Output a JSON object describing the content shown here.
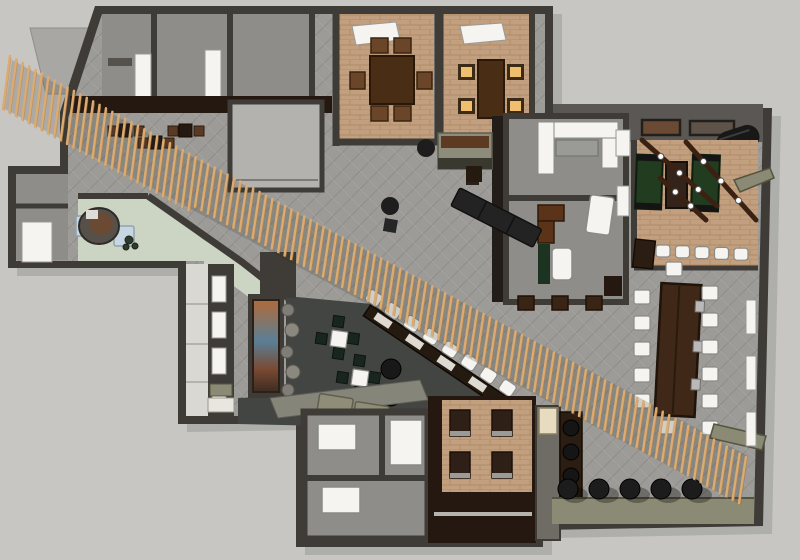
{
  "scene": {
    "kind": "3d-rendered-floor-plan",
    "subject": "restaurant-interior-top-down-render",
    "rooms": [
      "entry-lobby",
      "reception-desk",
      "private-dining-a",
      "private-dining-b",
      "service-rooms",
      "kitchen-prep",
      "office",
      "games-room",
      "main-hall",
      "diagonal-bar",
      "lounge",
      "communal-table-area",
      "restrooms",
      "booth-dining",
      "wine-storage",
      "window-gallery"
    ],
    "signature_feature": "diagonal-wood-slat-ceiling-band"
  },
  "palette": {
    "bg": "#c7c6c2",
    "wall": "#3f3c38",
    "wallMid": "#5a5754",
    "wallLight": "#6f6c68",
    "tile": "#9c9b97",
    "tileLine": "#8b8a86",
    "tan": "#c2a07f",
    "tanLine": "#a8875f",
    "sage": "#ccd4c4",
    "charcoal": "#434543",
    "walnut": "#241811",
    "woodDark": "#4a2d15",
    "wood": "#6b4527",
    "slat": "#ddaa6f",
    "white": "#f5f4f0",
    "greenTable": "#223c20",
    "cubeGreen": "#18261d",
    "amber": "#efbf6e",
    "lightBlue": "#c6d6e2",
    "olive": "#8b8a74",
    "black": "#1c1c1c",
    "roomGray": "#8e8d89",
    "lightRoom": "#b3b2ae",
    "muralOrange": "#b06a3a",
    "muralBlue": "#5a7f96"
  },
  "generated": {
    "slats": {
      "x_start": 10,
      "x_end": 746,
      "step": 6.4,
      "y_start": 56,
      "slope": 0.545,
      "len": 46,
      "len_long": 53,
      "lean": 7
    },
    "beams": [
      {
        "x1": 642,
        "y1": 140,
        "x2": 717,
        "y2": 206,
        "bulbs": 3
      },
      {
        "x1": 686,
        "y1": 142,
        "x2": 756,
        "y2": 220,
        "bulbs": 3
      },
      {
        "x1": 660,
        "y1": 178,
        "x2": 706,
        "y2": 220,
        "bulbs": 2
      }
    ],
    "communal": {
      "left": {
        "x": 634,
        "y": 290,
        "step": 26,
        "count": 5
      },
      "right": {
        "x": 702,
        "y": 286,
        "step": 27,
        "count": 6
      },
      "end_top": {
        "x": 666,
        "y": 262
      },
      "end_bottom": {
        "x": 660,
        "y": 420
      }
    },
    "bar_seats": {
      "x": 374,
      "y": 298,
      "angle": 34,
      "count": 8,
      "step": 23,
      "w": 15,
      "h": 13
    },
    "games_stools": {
      "x": 656,
      "y": 245,
      "step": 19.5,
      "count": 5,
      "w": 14,
      "h": 12
    },
    "floor_stools": {
      "x": 568,
      "y": 489,
      "step": 31,
      "count": 5,
      "r": 10
    },
    "west_panes": {
      "x": 212,
      "y": 276,
      "step": 36,
      "count": 4,
      "w": 14,
      "h": 26
    },
    "right_panes": {
      "x": 746,
      "y": 300,
      "step": 56,
      "count": 3,
      "w": 10,
      "h": 34
    },
    "booths": {
      "xs": [
        450,
        492
      ],
      "ys": [
        410,
        452
      ],
      "w": 20,
      "h": 26
    },
    "lounge_sets": [
      {
        "x": 331,
        "y": 331
      },
      {
        "x": 352,
        "y": 370
      }
    ],
    "nook_sets": [
      {
        "x": 125,
        "y": 124
      },
      {
        "x": 155,
        "y": 136
      },
      {
        "x": 185,
        "y": 124
      }
    ],
    "shelf_rounds": {
      "x": 571,
      "y": 428,
      "step": 24,
      "count": 3,
      "r": 8
    }
  }
}
